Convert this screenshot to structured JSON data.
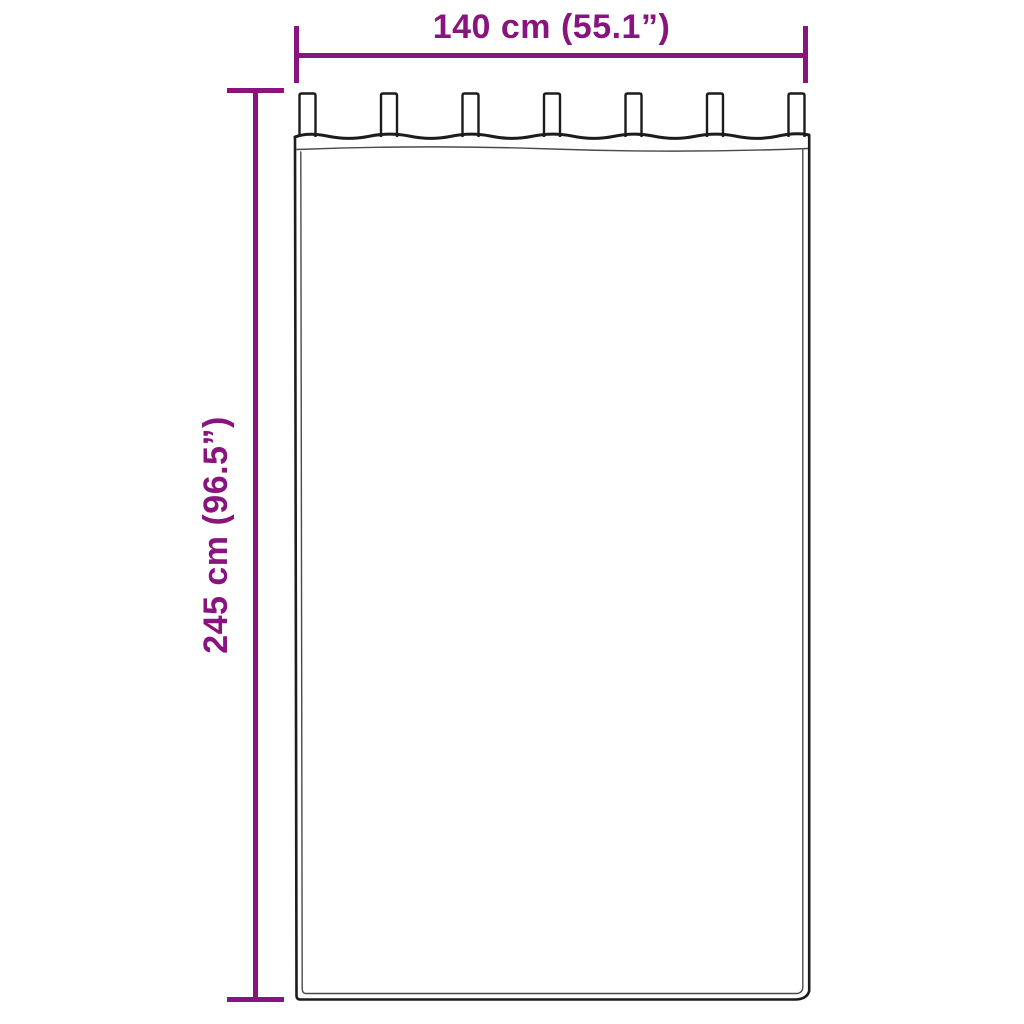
{
  "colors": {
    "accent": "#8a147e",
    "outline": "#1c1c1c",
    "seam": "#4a4a4a",
    "canvas": "#ffffff"
  },
  "dimensions": {
    "width_label": "140 cm (55.1”)",
    "height_label": "245 cm (96.5”)"
  },
  "illustration": {
    "subject": "tab-top-curtain",
    "tab_count": 7
  }
}
